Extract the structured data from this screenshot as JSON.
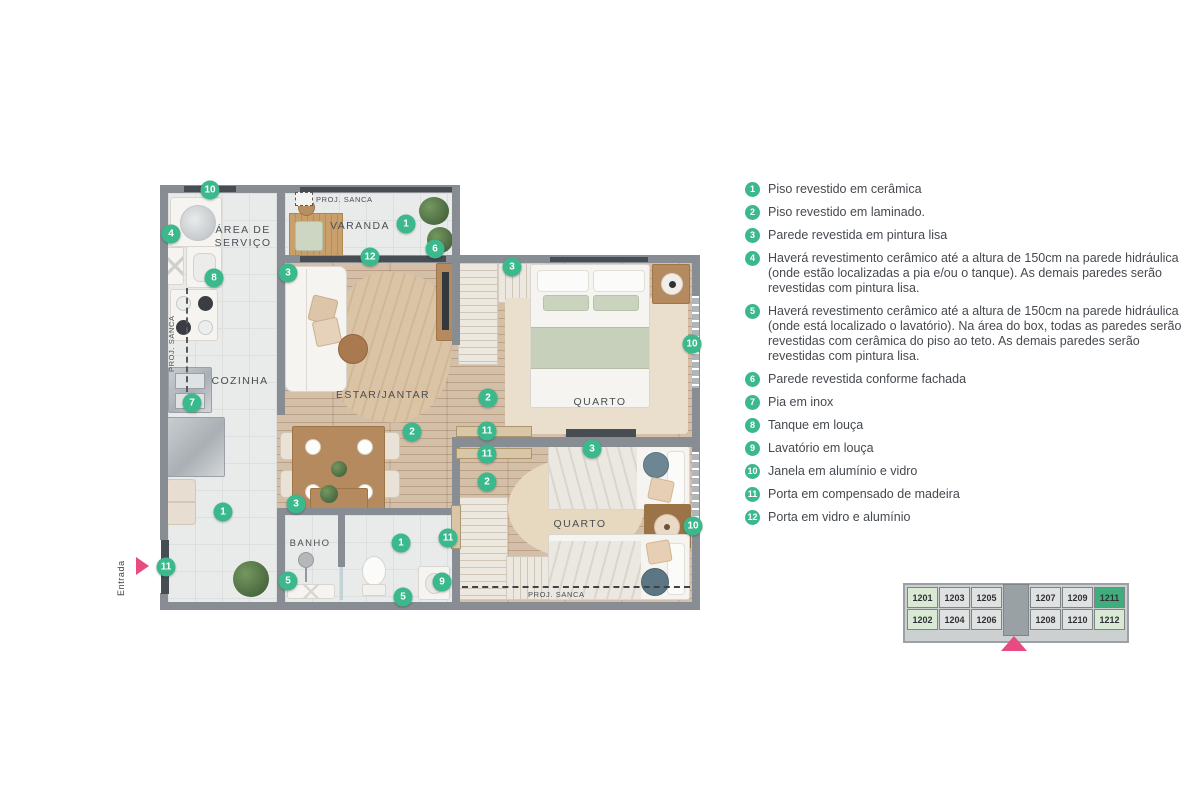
{
  "plan": {
    "rooms": [
      {
        "id": "area-servico",
        "label": "ÁREA DE SERVIÇO"
      },
      {
        "id": "varanda",
        "label": "VARANDA"
      },
      {
        "id": "cozinha",
        "label": "COZINHA"
      },
      {
        "id": "estar-jantar",
        "label": "ESTAR/JANTAR"
      },
      {
        "id": "quarto-1",
        "label": "QUARTO"
      },
      {
        "id": "quarto-2",
        "label": "QUARTO"
      },
      {
        "id": "banho",
        "label": "BANHO"
      }
    ],
    "annotations": {
      "proj_sanca": "PROJ. SANCA",
      "entrada": "Entrada"
    },
    "markers": [
      {
        "n": "10",
        "x": 210,
        "y": 190
      },
      {
        "n": "4",
        "x": 171,
        "y": 234
      },
      {
        "n": "8",
        "x": 214,
        "y": 278
      },
      {
        "n": "3",
        "x": 288,
        "y": 273
      },
      {
        "n": "1",
        "x": 406,
        "y": 224
      },
      {
        "n": "6",
        "x": 435,
        "y": 249
      },
      {
        "n": "12",
        "x": 370,
        "y": 257
      },
      {
        "n": "3",
        "x": 512,
        "y": 267
      },
      {
        "n": "10",
        "x": 692,
        "y": 344
      },
      {
        "n": "2",
        "x": 488,
        "y": 398
      },
      {
        "n": "2",
        "x": 412,
        "y": 432
      },
      {
        "n": "11",
        "x": 487,
        "y": 431
      },
      {
        "n": "11",
        "x": 487,
        "y": 454
      },
      {
        "n": "2",
        "x": 487,
        "y": 482
      },
      {
        "n": "3",
        "x": 592,
        "y": 449
      },
      {
        "n": "10",
        "x": 693,
        "y": 526
      },
      {
        "n": "7",
        "x": 192,
        "y": 403
      },
      {
        "n": "1",
        "x": 223,
        "y": 512
      },
      {
        "n": "3",
        "x": 296,
        "y": 504
      },
      {
        "n": "5",
        "x": 288,
        "y": 581
      },
      {
        "n": "1",
        "x": 401,
        "y": 543
      },
      {
        "n": "5",
        "x": 403,
        "y": 597
      },
      {
        "n": "9",
        "x": 442,
        "y": 582
      },
      {
        "n": "11",
        "x": 166,
        "y": 567
      },
      {
        "n": "11",
        "x": 448,
        "y": 538
      }
    ]
  },
  "legend": {
    "items": [
      {
        "n": "1",
        "text": "Piso revestido em cerâmica"
      },
      {
        "n": "2",
        "text": "Piso revestido em laminado."
      },
      {
        "n": "3",
        "text": "Parede revestida em pintura lisa"
      },
      {
        "n": "4",
        "text": "Haverá revestimento cerâmico até a altura de 150cm na parede hidráulica (onde estão localizadas a pia e/ou o tanque). As demais paredes serão revestidas com pintura lisa."
      },
      {
        "n": "5",
        "text": "Haverá revestimento cerâmico até a altura de 150cm na parede hidráulica (onde está localizado o lavatório). Na área do box, todas as paredes serão revestidas com cerâmica do piso ao teto. As demais paredes serão revestidas com pintura lisa."
      },
      {
        "n": "6",
        "text": "Parede revestida conforme fachada"
      },
      {
        "n": "7",
        "text": "Pia em inox"
      },
      {
        "n": "8",
        "text": "Tanque em louça"
      },
      {
        "n": "9",
        "text": "Lavatório em louça"
      },
      {
        "n": "10",
        "text": "Janela em alumínio e vidro"
      },
      {
        "n": "11",
        "text": "Porta em compensado de madeira"
      },
      {
        "n": "12",
        "text": "Porta em vidro e alumínio"
      }
    ]
  },
  "keyplan": {
    "columns": [
      {
        "type": "end",
        "cells": [
          "1201",
          "1202"
        ]
      },
      {
        "type": "mid",
        "cells": [
          "1203",
          "1204"
        ]
      },
      {
        "type": "mid",
        "cells": [
          "1205",
          "1206"
        ]
      },
      {
        "type": "core"
      },
      {
        "type": "mid",
        "cells": [
          "1207",
          "1208"
        ]
      },
      {
        "type": "mid",
        "cells": [
          "1209",
          "1210"
        ]
      },
      {
        "type": "end",
        "cells": [
          "1211",
          "1212"
        ]
      }
    ],
    "selected": "1211",
    "light_units": [
      "1201",
      "1202",
      "1212"
    ]
  },
  "colors": {
    "accent_green": "#3cb98c",
    "accent_pink": "#e84a82",
    "keyplan_selected": "#3fae7c",
    "keyplan_light": "#d9e9d4"
  }
}
